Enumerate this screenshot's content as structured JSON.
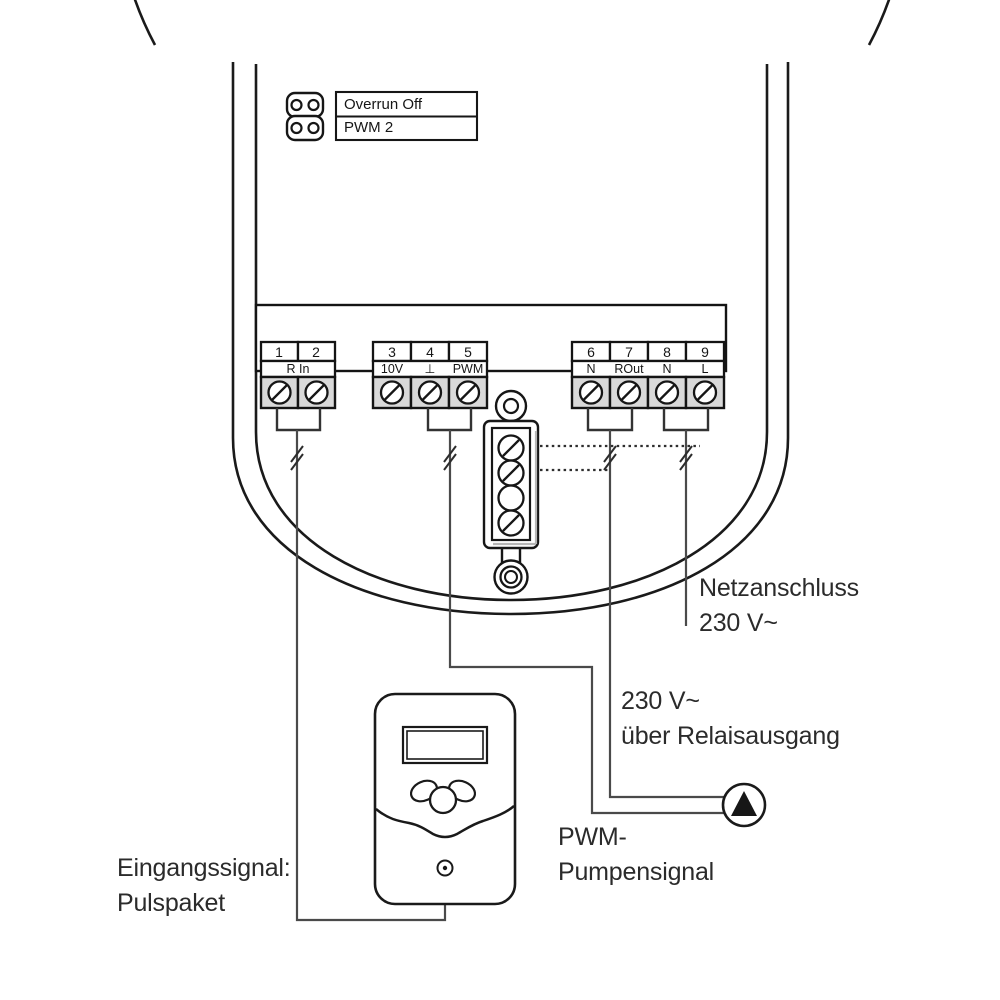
{
  "diagram_title": "controller-terminal-wiring",
  "colors": {
    "line": "#1a1a1a",
    "wire": "#4a4a4a",
    "terminal_fill": "#d9d9d9",
    "text": "#2b2b2b"
  },
  "jumper": {
    "option_top": "Overrun Off",
    "option_bottom": "PWM 2"
  },
  "terminals": {
    "groups": [
      {
        "numbers": [
          "1",
          "2"
        ],
        "label": "R In"
      },
      {
        "numbers": [
          "3",
          "4",
          "5"
        ],
        "labels": [
          "10V",
          "⊥",
          "PWM"
        ]
      },
      {
        "numbers": [
          "6",
          "7",
          "8",
          "9"
        ],
        "labels": [
          "N",
          "ROut",
          "N",
          "L"
        ]
      }
    ]
  },
  "annotations": {
    "mains": {
      "line1": "Netzanschluss",
      "line2": "230 V~"
    },
    "relay": {
      "line1": "230 V~",
      "line2": "über Relaisausgang"
    },
    "pwm_signal": {
      "line1": "PWM-",
      "line2": "Pumpensignal"
    },
    "input_signal": {
      "line1": "Eingangssignal:",
      "line2": "Pulspaket"
    }
  }
}
